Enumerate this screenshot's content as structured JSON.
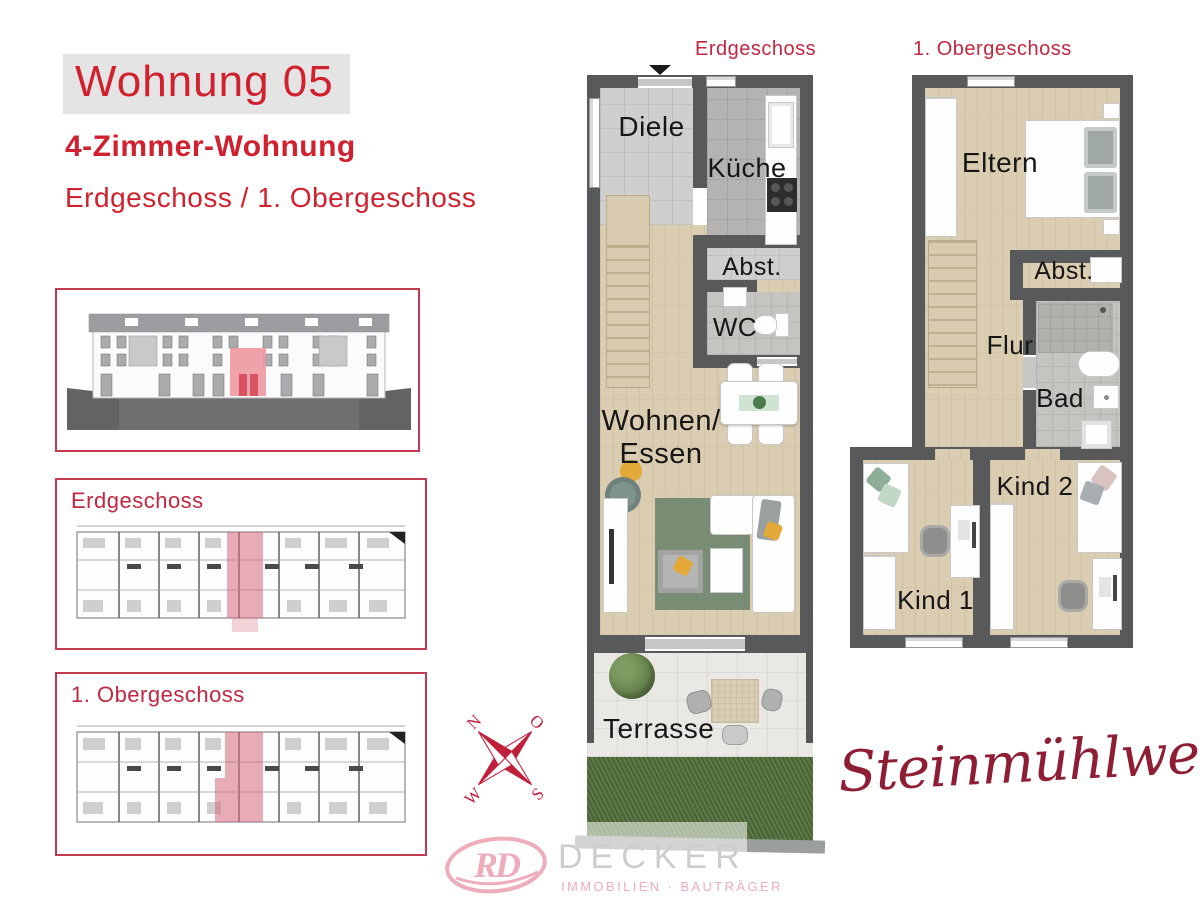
{
  "header": {
    "title": "Wohnung 05",
    "subtitle": "4-Zimmer-Wohnung",
    "floors_line": "Erdgeschoss / 1. Obergeschoss"
  },
  "overview_panels": {
    "ground_label": "Erdgeschoss",
    "upper_label": "1. Obergeschoss"
  },
  "ground_plan": {
    "header": "Erdgeschoss",
    "rooms": {
      "diele": "Diele",
      "kueche": "Küche",
      "abstellraum": "Abst.",
      "wc": "WC",
      "wohnen_line1": "Wohnen/",
      "wohnen_line2": "Essen",
      "terrasse": "Terrasse"
    }
  },
  "upper_plan": {
    "header": "1. Obergeschoss",
    "rooms": {
      "eltern": "Eltern",
      "abstellraum": "Abst.",
      "flur": "Flur",
      "bad": "Bad",
      "kind2": "Kind 2",
      "kind1": "Kind 1"
    }
  },
  "compass": {
    "north": "N",
    "east": "O",
    "south": "S",
    "west": "W"
  },
  "project_name": "Steinmühlweg",
  "logo": {
    "monogram": "RD",
    "company": "DECKER",
    "tagline": "IMMOBILIEN · BAUTRÄGER"
  },
  "colors": {
    "brand_red": "#d0212f",
    "highlight_pink": "#e0798a",
    "script_red": "#8e1e33",
    "logo_pink": "#eeadbb",
    "wall_gray": "#58595b"
  }
}
